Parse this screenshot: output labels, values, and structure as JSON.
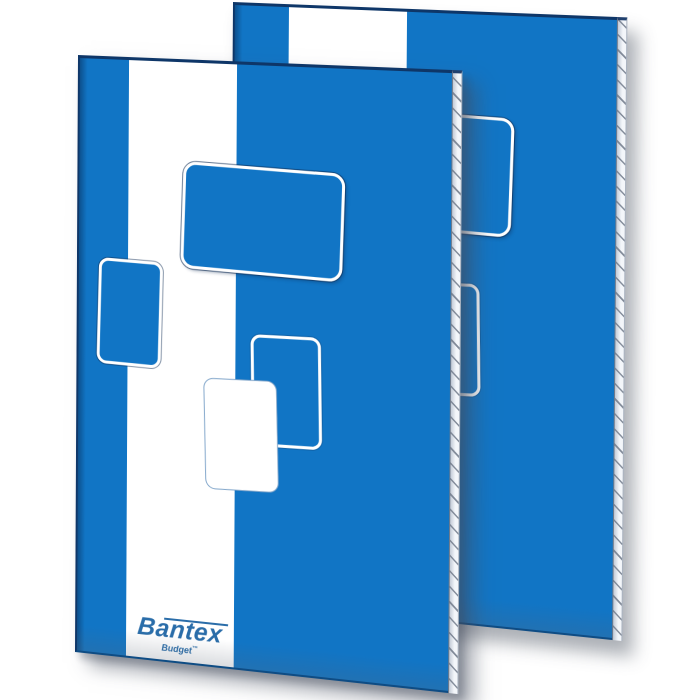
{
  "scene": {
    "type": "product-photo",
    "description": "Two upright blue Bantex Budget notepads, one standing in front of the other, on a white background",
    "background_color": "#ffffff"
  },
  "brand": {
    "name": "Bantex",
    "subtitle": "Budget",
    "trademark": "™"
  },
  "colors": {
    "cover_blue": "#1175c5",
    "edge_navy": "#0e3668",
    "stripe_white": "#ffffff",
    "design_border_white": "#ffffff",
    "page_edge_light": "#f3f6fa",
    "page_edge_hatch": "#6e7888",
    "logo_blue": "#2a6da9",
    "shadow_gray": "rgba(72,80,94,0.45)"
  }
}
